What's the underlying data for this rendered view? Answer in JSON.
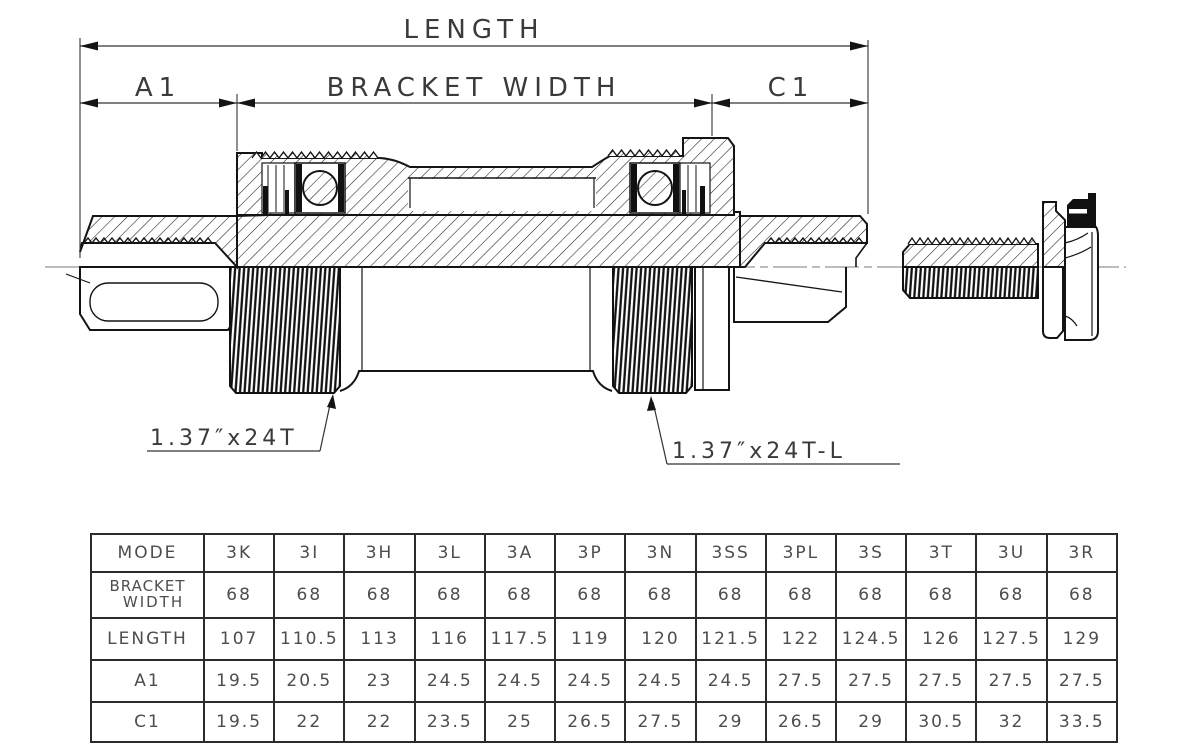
{
  "drawing": {
    "length_label": "LENGTH",
    "a1_label": "A1",
    "bracket_width_label": "BRACKET WIDTH",
    "c1_label": "C1",
    "thread_left_label": "1.37″x24T",
    "thread_right_label": "1.37″x24T-L",
    "line_color": "#141414",
    "text_color": "#3a3a3a"
  },
  "table": {
    "header": [
      "MODE",
      "3K",
      "3I",
      "3H",
      "3L",
      "3A",
      "3P",
      "3N",
      "3SS",
      "3PL",
      "3S",
      "3T",
      "3U",
      "3R"
    ],
    "rows": [
      {
        "label": "BRACKET WIDTH",
        "label_lines": [
          "BRACKET",
          "WIDTH"
        ],
        "values": [
          "68",
          "68",
          "68",
          "68",
          "68",
          "68",
          "68",
          "68",
          "68",
          "68",
          "68",
          "68",
          "68"
        ]
      },
      {
        "label": "LENGTH",
        "values": [
          "107",
          "110.5",
          "113",
          "116",
          "117.5",
          "119",
          "120",
          "121.5",
          "122",
          "124.5",
          "126",
          "127.5",
          "129"
        ]
      },
      {
        "label": "A1",
        "values": [
          "19.5",
          "20.5",
          "23",
          "24.5",
          "24.5",
          "24.5",
          "24.5",
          "24.5",
          "27.5",
          "27.5",
          "27.5",
          "27.5",
          "27.5"
        ]
      },
      {
        "label": "C1",
        "values": [
          "19.5",
          "22",
          "22",
          "23.5",
          "25",
          "26.5",
          "27.5",
          "29",
          "26.5",
          "29",
          "30.5",
          "32",
          "33.5"
        ]
      }
    ]
  }
}
